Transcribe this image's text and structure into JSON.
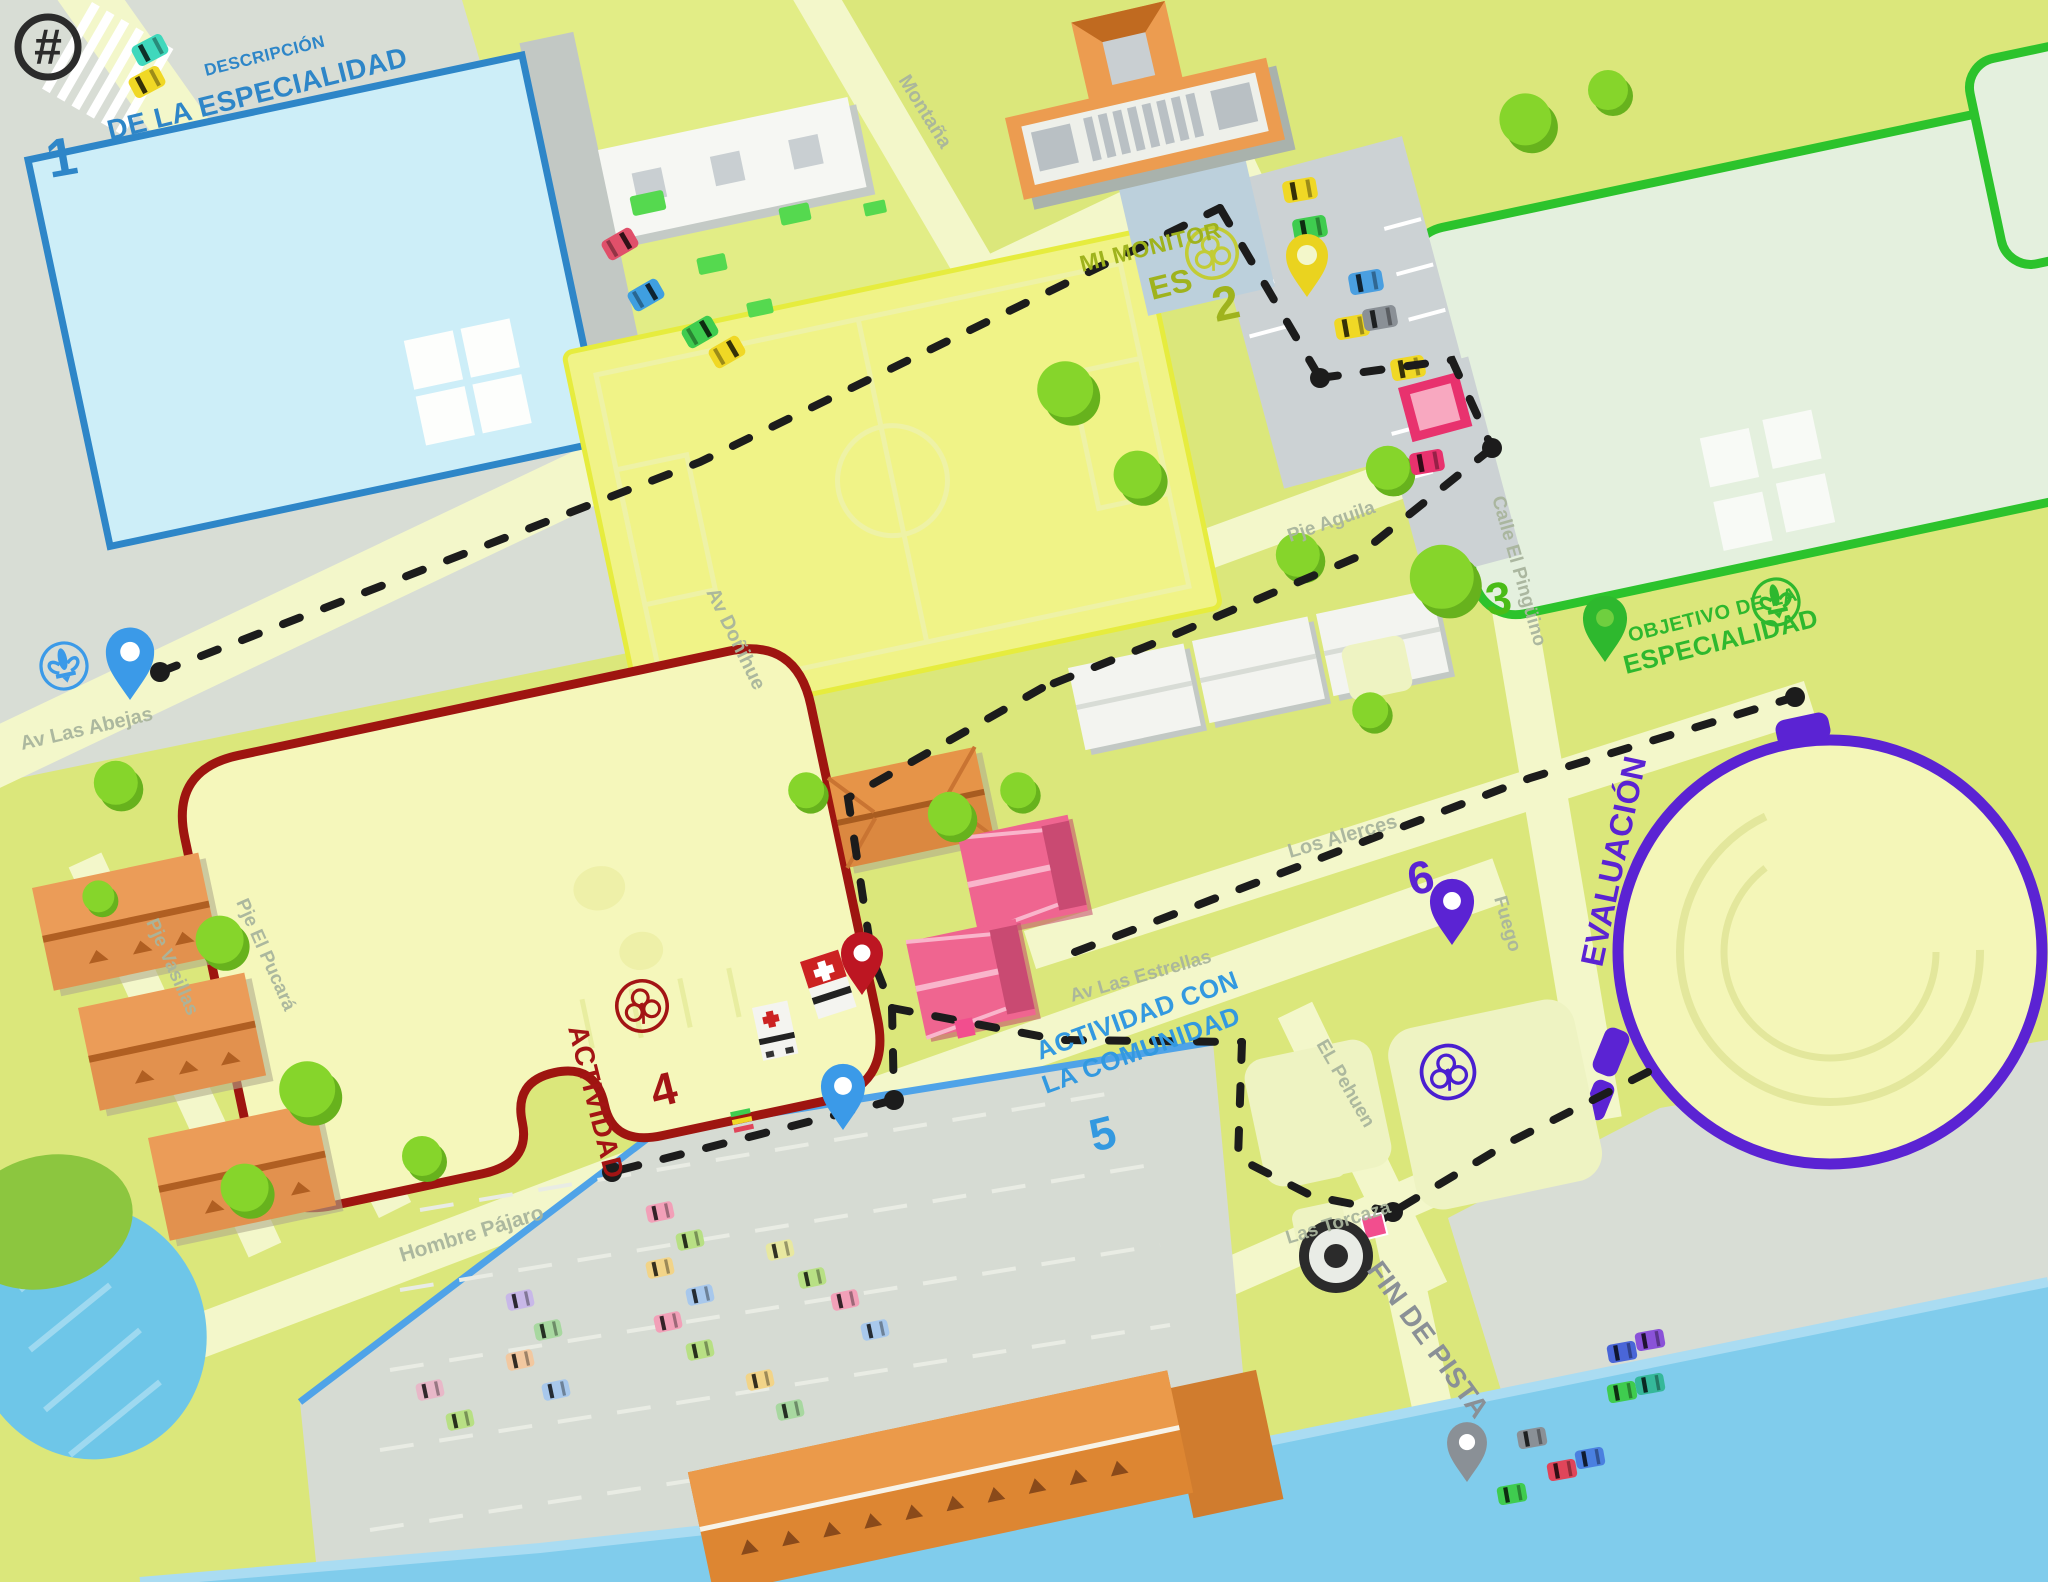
{
  "map": {
    "logo_glyph": "#",
    "stations": [
      {
        "number": "1",
        "lines": [
          "DESCRIPCIÓN",
          "DE LA ESPECIALIDAD"
        ],
        "color": "#2e86c8"
      },
      {
        "number": "2",
        "lines": [
          "MI MONITOR",
          "ES"
        ],
        "color": "#9fb31d"
      },
      {
        "number": "3",
        "lines": [],
        "color": "#4abc17"
      },
      {
        "number": "4",
        "lines": [
          "ACTIVIDAD"
        ],
        "color": "#a31414"
      },
      {
        "number": "5",
        "lines": [
          "ACTIVIDAD CON",
          "LA COMUNIDAD"
        ],
        "color": "#3399e0"
      },
      {
        "number": "6",
        "lines": [
          "EVALUACIÓN"
        ],
        "color": "#5b23d3"
      }
    ],
    "objective": {
      "lines": [
        "OBJETIVO DE LA",
        "ESPECIALIDAD"
      ],
      "color": "#2eb82e"
    },
    "finish": {
      "label": "FIN DE PISTA",
      "color": "#8a9096"
    },
    "streets": [
      "Av Las Abejas",
      "Montaña",
      "Av Doñihue",
      "Pje Aguila",
      "Calle El Pingüino",
      "Los Alerces",
      "Av Las Estrellas",
      "Fuego",
      "EL Pehuen",
      "Las Torcaza",
      "Hombre Pájaro",
      "Pje Vasillas",
      "Pje El Pucará"
    ],
    "icons": {
      "logo": "circled-hash",
      "pin": "map-pin",
      "scout_emblem": "fleur-de-lis",
      "guide_emblem": "trefoil",
      "finish_target": "bullseye",
      "ambulance": "red-cross-vehicle"
    },
    "colors": {
      "background": "#dbe77b",
      "road": "#f3f7ca",
      "pavement": "#d8ddd5",
      "water": "#80ccec",
      "pool": "#cdeef8",
      "pool_border": "#2e86c8",
      "soccer_border": "#e6ec3e",
      "green_field_border": "#2cc32c",
      "track_border": "#9e1510",
      "velodrome": "#5b23d3",
      "trail": "#1c1c1c",
      "pin_start": "#3b9ae8",
      "pin_activity": "#bd1622",
      "pin_parking": "#ead31f",
      "pin_eval": "#5b23d3",
      "pin_objective": "#2eb82e",
      "pin_finish": "#8a9096"
    }
  }
}
